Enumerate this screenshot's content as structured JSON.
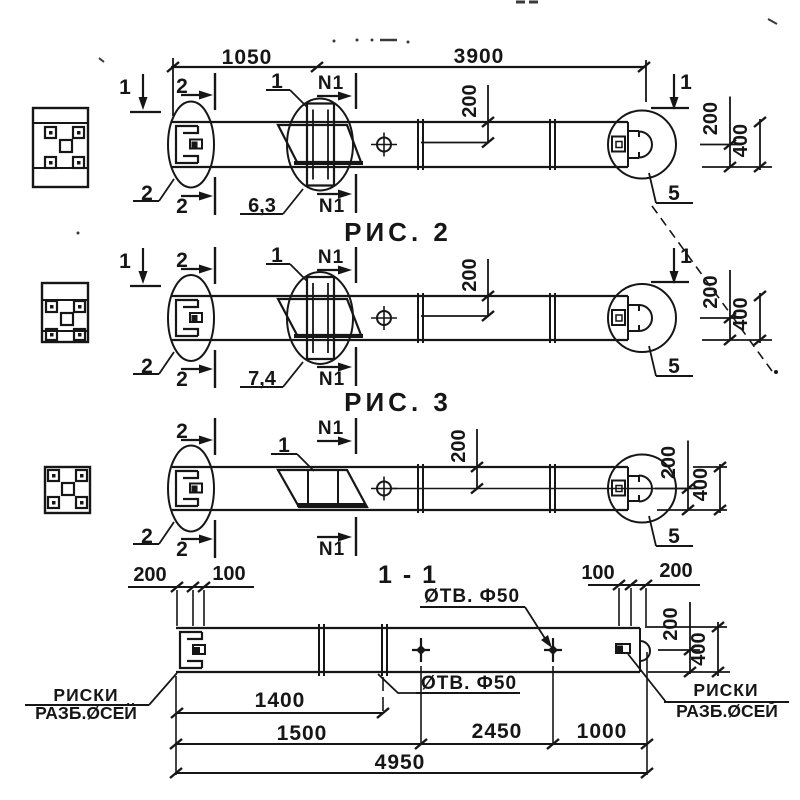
{
  "titles": {
    "fig2": "РИС. 2",
    "fig3": "РИС. 3",
    "section": "1 - 1"
  },
  "dimensions": {
    "span_left": "1050",
    "span_right": "3900",
    "half_height": "200",
    "full_height": "400",
    "edge_offset_200": "200",
    "edge_offset_100": "100",
    "axis_offset_1400": "1400",
    "hole1_offset_1500": "1500",
    "hole_spacing_2450": "2450",
    "hole_end_offset_1000": "1000",
    "total_length_4950": "4950"
  },
  "section_marks": {
    "cut_1": "1",
    "cut_2": "2",
    "cut_n1": "N1"
  },
  "detail_marks": {
    "detail_1": "1",
    "detail_2": "2",
    "detail_5": "5"
  },
  "weld_marks": {
    "fig2_weld": "6,3",
    "fig3_weld": "7,4"
  },
  "callouts": {
    "holes": "ØТВ. Ф50",
    "riski_line1": "РИСКИ",
    "riski_line2": "РАЗБ.ØСЕЙ"
  },
  "colors": {
    "ink": "#161616",
    "paper": "#ffffff"
  }
}
